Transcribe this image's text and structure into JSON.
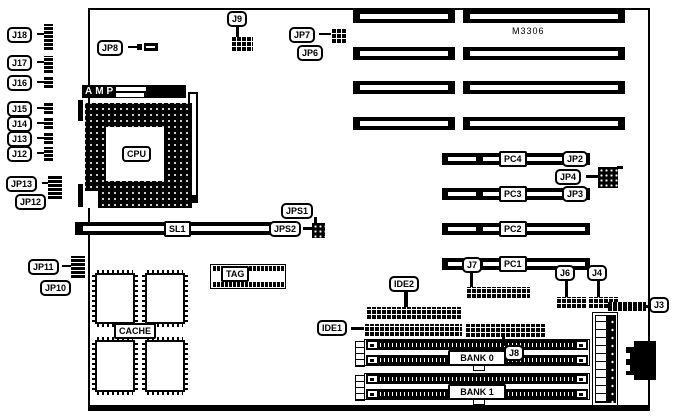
{
  "diagram_type": "motherboard-layout",
  "board": {
    "model": "M3306"
  },
  "colors": {
    "line": "#000000",
    "background": "#ffffff"
  },
  "labels": {
    "j18": "J18",
    "j17": "J17",
    "j16": "J16",
    "j15": "J15",
    "j14": "J14",
    "j13": "J13",
    "j12": "J12",
    "jp13": "JP13",
    "jp12": "JP12",
    "jp11": "JP11",
    "jp10": "JP10",
    "jp8": "JP8",
    "amp": "AMP",
    "cpu": "CPU",
    "j9": "J9",
    "jp7": "JP7",
    "jp6": "JP6",
    "model": "M3306",
    "pc4": "PC4",
    "pc3": "PC3",
    "pc2": "PC2",
    "pc1": "PC1",
    "jp2": "JP2",
    "jp4": "JP4",
    "jp3": "JP3",
    "sl1": "SL1",
    "jps1": "JPS1",
    "jps2": "JPS2",
    "tag": "TAG",
    "cache": "CACHE",
    "ide2": "IDE2",
    "ide1": "IDE1",
    "j7": "J7",
    "j8": "J8",
    "j6": "J6",
    "j4": "J4",
    "j3": "J3",
    "bank0": "BANK 0",
    "bank1": "BANK 1"
  }
}
